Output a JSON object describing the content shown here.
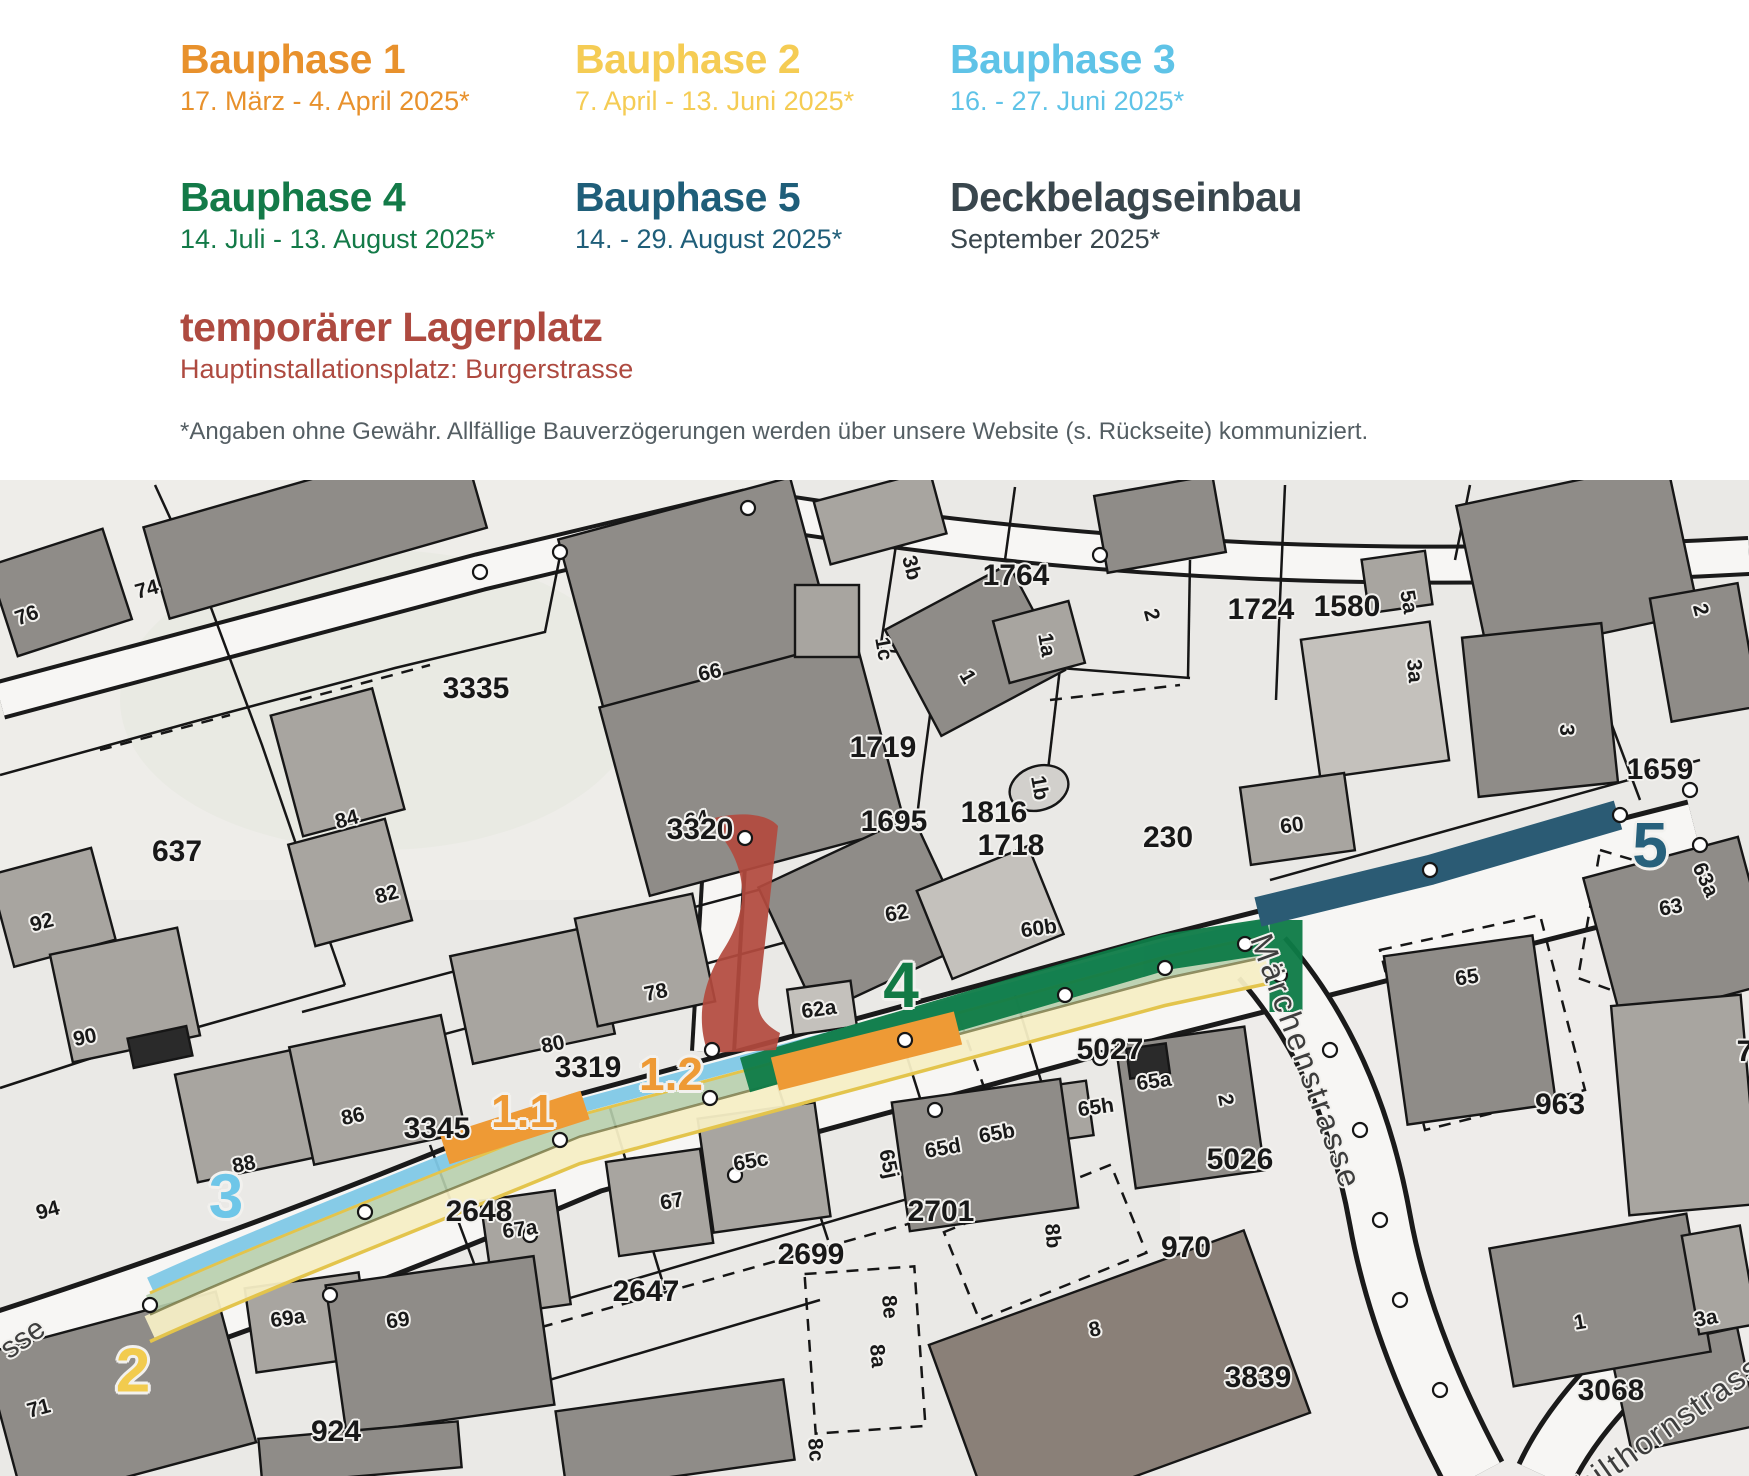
{
  "legend": {
    "phases": [
      {
        "title": "Bauphase 1",
        "dates": "17. März - 4. April 2025*",
        "color": "#E8912C",
        "style": {
          "left": "180px",
          "top": "38px",
          "color": "#E8912C"
        }
      },
      {
        "title": "Bauphase 2",
        "dates": "7. April - 13. Juni 2025*",
        "color": "#F5CC54",
        "style": {
          "left": "575px",
          "top": "38px",
          "color": "#F5CC54"
        }
      },
      {
        "title": "Bauphase 3",
        "dates": "16. - 27. Juni 2025*",
        "color": "#5FC3E7",
        "style": {
          "left": "950px",
          "top": "38px",
          "color": "#5FC3E7"
        }
      },
      {
        "title": "Bauphase 4",
        "dates": "14. Juli - 13. August 2025*",
        "color": "#137A48",
        "style": {
          "left": "180px",
          "top": "176px",
          "color": "#137A48"
        }
      },
      {
        "title": "Bauphase 5",
        "dates": "14. - 29. August 2025*",
        "color": "#1F5E79",
        "style": {
          "left": "575px",
          "top": "176px",
          "color": "#1F5E79"
        }
      },
      {
        "title": "Deckbelagseinbau",
        "dates": "September 2025*",
        "color": "#39464D",
        "style": {
          "left": "950px",
          "top": "176px",
          "color": "#39464D"
        }
      }
    ],
    "storage": {
      "title": "temporärer Lagerplatz",
      "subtitle": "Hauptinstallationsplatz: Burgerstrasse",
      "color": "#AE4A40"
    },
    "disclaimer": "*Angaben ohne Gewähr. Allfällige Bauverzögerungen werden über unsere Website (s. Rückseite) kommuniziert."
  },
  "map": {
    "colors": {
      "phase1_band": "#EE9A35",
      "phase2_fill": "#F6EEC5",
      "phase2_line": "#E3C44C",
      "phase3_band": "#7FC8E6",
      "phase4_band": "#0E7B47",
      "phase5_band": "#2B5B74",
      "storage_fill": "#B34A3E",
      "paving_band": "#B7CFAD"
    },
    "phase_markers": [
      {
        "text": "1.1",
        "style": {
          "left": "523px",
          "top": "1111px",
          "color": "#EE9A35",
          "fontSize": "46px"
        }
      },
      {
        "text": "1.2",
        "style": {
          "left": "671px",
          "top": "1074px",
          "color": "#EE9A35",
          "fontSize": "46px"
        }
      },
      {
        "text": "2",
        "style": {
          "left": "133px",
          "top": "1371px",
          "color": "#F2CB4E",
          "fontSize": "62px"
        }
      },
      {
        "text": "3",
        "style": {
          "left": "226px",
          "top": "1197px",
          "color": "#6EC6E8",
          "fontSize": "62px"
        }
      },
      {
        "text": "4",
        "style": {
          "left": "901px",
          "top": "985px",
          "color": "#127A45",
          "fontSize": "64px"
        }
      },
      {
        "text": "5",
        "style": {
          "left": "1650px",
          "top": "845px",
          "color": "#27617C",
          "fontSize": "64px"
        }
      }
    ],
    "street_labels": [
      {
        "text": "Märchenstrasse",
        "style": {
          "left": "1306px",
          "top": "1062px",
          "transform": "translate(-50%,-50%) rotate(70deg)",
          "fontSize": "32px",
          "letterSpacing": "3px"
        }
      },
      {
        "text": "Schilthornstrasse",
        "style": {
          "left": "1660px",
          "top": "1432px",
          "transform": "translate(-50%,-50%) rotate(-35deg)",
          "fontSize": "32px",
          "letterSpacing": "2px"
        }
      },
      {
        "text": "sse",
        "style": {
          "left": "23px",
          "top": "1339px",
          "transform": "translate(-50%,-50%) rotate(-35deg)",
          "fontSize": "30px"
        }
      }
    ],
    "parcel_labels": [
      {
        "text": "3335",
        "style": {
          "left": "476px",
          "top": "689px"
        }
      },
      {
        "text": "637",
        "style": {
          "left": "177px",
          "top": "852px"
        }
      },
      {
        "text": "1764",
        "style": {
          "left": "1016px",
          "top": "576px"
        }
      },
      {
        "text": "1719",
        "style": {
          "left": "883px",
          "top": "748px"
        }
      },
      {
        "text": "1695",
        "style": {
          "left": "894px",
          "top": "822px"
        }
      },
      {
        "text": "1816",
        "style": {
          "left": "994px",
          "top": "813px"
        }
      },
      {
        "text": "1718",
        "style": {
          "left": "1011px",
          "top": "846px"
        }
      },
      {
        "text": "1724",
        "style": {
          "left": "1261px",
          "top": "610px"
        }
      },
      {
        "text": "1580",
        "style": {
          "left": "1347px",
          "top": "607px"
        }
      },
      {
        "text": "1659",
        "style": {
          "left": "1660px",
          "top": "770px"
        }
      },
      {
        "text": "3320",
        "style": {
          "left": "700px",
          "top": "830px"
        }
      },
      {
        "text": "3319",
        "style": {
          "left": "588px",
          "top": "1068px"
        }
      },
      {
        "text": "3345",
        "style": {
          "left": "437px",
          "top": "1129px"
        }
      },
      {
        "text": "230",
        "style": {
          "left": "1168px",
          "top": "838px"
        }
      },
      {
        "text": "5027",
        "style": {
          "left": "1110px",
          "top": "1050px"
        }
      },
      {
        "text": "963",
        "style": {
          "left": "1560px",
          "top": "1105px"
        }
      },
      {
        "text": "5026",
        "style": {
          "left": "1240px",
          "top": "1160px"
        }
      },
      {
        "text": "970",
        "style": {
          "left": "1186px",
          "top": "1248px"
        }
      },
      {
        "text": "2701",
        "style": {
          "left": "941px",
          "top": "1212px"
        }
      },
      {
        "text": "2699",
        "style": {
          "left": "811px",
          "top": "1255px"
        }
      },
      {
        "text": "2647",
        "style": {
          "left": "646px",
          "top": "1292px"
        }
      },
      {
        "text": "2648",
        "style": {
          "left": "479px",
          "top": "1212px"
        }
      },
      {
        "text": "3839",
        "style": {
          "left": "1258px",
          "top": "1378px"
        }
      },
      {
        "text": "3068",
        "style": {
          "left": "1611px",
          "top": "1391px"
        }
      },
      {
        "text": "924",
        "style": {
          "left": "336px",
          "top": "1432px"
        }
      },
      {
        "text": "7",
        "style": {
          "left": "1745px",
          "top": "1052px"
        }
      }
    ],
    "house_labels": [
      {
        "text": "76",
        "style": {
          "left": "27px",
          "top": "616px",
          "transform": "translate(-50%,-50%) rotate(-20deg)"
        }
      },
      {
        "text": "74",
        "style": {
          "left": "147px",
          "top": "590px",
          "transform": "translate(-50%,-50%) rotate(-15deg)"
        }
      },
      {
        "text": "84",
        "style": {
          "left": "347px",
          "top": "820px",
          "transform": "translate(-50%,-50%) rotate(-15deg)"
        }
      },
      {
        "text": "82",
        "style": {
          "left": "387px",
          "top": "895px",
          "transform": "translate(-50%,-50%) rotate(-15deg)"
        }
      },
      {
        "text": "92",
        "style": {
          "left": "42px",
          "top": "923px",
          "transform": "translate(-50%,-50%) rotate(-15deg)"
        }
      },
      {
        "text": "90",
        "style": {
          "left": "85px",
          "top": "1038px",
          "transform": "translate(-50%,-50%) rotate(-12deg)"
        }
      },
      {
        "text": "80",
        "style": {
          "left": "553px",
          "top": "1045px",
          "transform": "translate(-50%,-50%) rotate(-12deg)"
        }
      },
      {
        "text": "86",
        "style": {
          "left": "353px",
          "top": "1117px",
          "transform": "translate(-50%,-50%) rotate(-12deg)"
        }
      },
      {
        "text": "88",
        "style": {
          "left": "244px",
          "top": "1165px",
          "transform": "translate(-50%,-50%) rotate(-12deg)"
        }
      },
      {
        "text": "94",
        "style": {
          "left": "48px",
          "top": "1211px",
          "transform": "translate(-50%,-50%) rotate(-15deg)"
        }
      },
      {
        "text": "71",
        "style": {
          "left": "39px",
          "top": "1409px",
          "transform": "translate(-50%,-50%) rotate(-15deg)"
        }
      },
      {
        "text": "66",
        "style": {
          "left": "710px",
          "top": "673px",
          "transform": "translate(-50%,-50%) rotate(-12deg)"
        }
      },
      {
        "text": "64",
        "style": {
          "left": "697px",
          "top": "820px",
          "transform": "translate(-50%,-50%) rotate(-12deg)"
        }
      },
      {
        "text": "78",
        "style": {
          "left": "656px",
          "top": "993px",
          "transform": "translate(-50%,-50%) rotate(-12deg)"
        }
      },
      {
        "text": "62",
        "style": {
          "left": "897px",
          "top": "914px",
          "transform": "translate(-50%,-50%) rotate(-10deg)"
        }
      },
      {
        "text": "62a",
        "style": {
          "left": "819px",
          "top": "1010px",
          "transform": "translate(-50%,-50%) rotate(-8deg)"
        }
      },
      {
        "text": "60b",
        "style": {
          "left": "1039px",
          "top": "929px",
          "transform": "translate(-50%,-50%) rotate(-8deg)"
        }
      },
      {
        "text": "60",
        "style": {
          "left": "1292px",
          "top": "826px",
          "transform": "translate(-50%,-50%) rotate(-8deg)"
        }
      },
      {
        "text": "3b",
        "style": {
          "left": "911px",
          "top": "568px",
          "transform": "translate(-50%,-50%) rotate(75deg)"
        }
      },
      {
        "text": "1c",
        "style": {
          "left": "883px",
          "top": "649px",
          "transform": "translate(-50%,-50%) rotate(80deg)"
        }
      },
      {
        "text": "1",
        "style": {
          "left": "967px",
          "top": "677px",
          "transform": "translate(-50%,-50%) rotate(60deg)"
        }
      },
      {
        "text": "1a",
        "style": {
          "left": "1046px",
          "top": "645px",
          "transform": "translate(-50%,-50%) rotate(80deg)"
        }
      },
      {
        "text": "2",
        "style": {
          "left": "1151px",
          "top": "615px",
          "transform": "translate(-50%,-50%) rotate(75deg)"
        }
      },
      {
        "text": "2",
        "style": {
          "left": "1700px",
          "top": "610px",
          "transform": "translate(-50%,-50%) rotate(75deg)"
        }
      },
      {
        "text": "1b",
        "style": {
          "left": "1039px",
          "top": "788px",
          "transform": "translate(-50%,-50%) rotate(80deg)"
        }
      },
      {
        "text": "5a",
        "style": {
          "left": "1408px",
          "top": "602px",
          "transform": "translate(-50%,-50%) rotate(80deg)"
        }
      },
      {
        "text": "3a",
        "style": {
          "left": "1414px",
          "top": "671px",
          "transform": "translate(-50%,-50%) rotate(85deg)"
        }
      },
      {
        "text": "3",
        "style": {
          "left": "1566px",
          "top": "730px",
          "transform": "translate(-50%,-50%) rotate(90deg)"
        }
      },
      {
        "text": "63a",
        "style": {
          "left": "1705px",
          "top": "880px",
          "transform": "translate(-50%,-50%) rotate(65deg)"
        }
      },
      {
        "text": "63",
        "style": {
          "left": "1671px",
          "top": "908px",
          "transform": "translate(-50%,-50%) rotate(-10deg)"
        }
      },
      {
        "text": "65",
        "style": {
          "left": "1467px",
          "top": "978px",
          "transform": "translate(-50%,-50%) rotate(-8deg)"
        }
      },
      {
        "text": "65a",
        "style": {
          "left": "1154px",
          "top": "1082px",
          "transform": "translate(-50%,-50%) rotate(-8deg)"
        }
      },
      {
        "text": "65h",
        "style": {
          "left": "1096px",
          "top": "1108px",
          "transform": "translate(-50%,-50%) rotate(-8deg)"
        }
      },
      {
        "text": "2",
        "style": {
          "left": "1225px",
          "top": "1100px",
          "transform": "translate(-50%,-50%) rotate(80deg)"
        }
      },
      {
        "text": "65b",
        "style": {
          "left": "997px",
          "top": "1134px",
          "transform": "translate(-50%,-50%) rotate(-10deg)"
        }
      },
      {
        "text": "65d",
        "style": {
          "left": "943px",
          "top": "1149px",
          "transform": "translate(-50%,-50%) rotate(-10deg)"
        }
      },
      {
        "text": "65j",
        "style": {
          "left": "888px",
          "top": "1164px",
          "transform": "translate(-50%,-50%) rotate(78deg)"
        }
      },
      {
        "text": "65c",
        "style": {
          "left": "751px",
          "top": "1162px",
          "transform": "translate(-50%,-50%) rotate(-10deg)"
        }
      },
      {
        "text": "67",
        "style": {
          "left": "672px",
          "top": "1202px",
          "transform": "translate(-50%,-50%) rotate(-10deg)"
        }
      },
      {
        "text": "67a",
        "style": {
          "left": "520px",
          "top": "1230px",
          "transform": "translate(-50%,-50%) rotate(-8deg)"
        }
      },
      {
        "text": "69a",
        "style": {
          "left": "288px",
          "top": "1319px",
          "transform": "translate(-50%,-50%) rotate(-8deg)"
        }
      },
      {
        "text": "69",
        "style": {
          "left": "398px",
          "top": "1321px",
          "transform": "translate(-50%,-50%) rotate(-8deg)"
        }
      },
      {
        "text": "8e",
        "style": {
          "left": "889px",
          "top": "1307px",
          "transform": "translate(-50%,-50%) rotate(85deg)"
        }
      },
      {
        "text": "8a",
        "style": {
          "left": "877px",
          "top": "1356px",
          "transform": "translate(-50%,-50%) rotate(85deg)"
        }
      },
      {
        "text": "8c",
        "style": {
          "left": "815px",
          "top": "1450px",
          "transform": "translate(-50%,-50%) rotate(85deg)"
        }
      },
      {
        "text": "8b",
        "style": {
          "left": "1052px",
          "top": "1236px",
          "transform": "translate(-50%,-50%) rotate(85deg)"
        }
      },
      {
        "text": "8",
        "style": {
          "left": "1095px",
          "top": "1330px",
          "transform": "translate(-50%,-50%) rotate(-12deg)"
        }
      },
      {
        "text": "1",
        "style": {
          "left": "1580px",
          "top": "1323px",
          "transform": "translate(-50%,-50%) rotate(-10deg)"
        }
      },
      {
        "text": "3a",
        "style": {
          "left": "1706px",
          "top": "1319px",
          "transform": "translate(-50%,-50%) rotate(-10deg)"
        }
      }
    ]
  }
}
